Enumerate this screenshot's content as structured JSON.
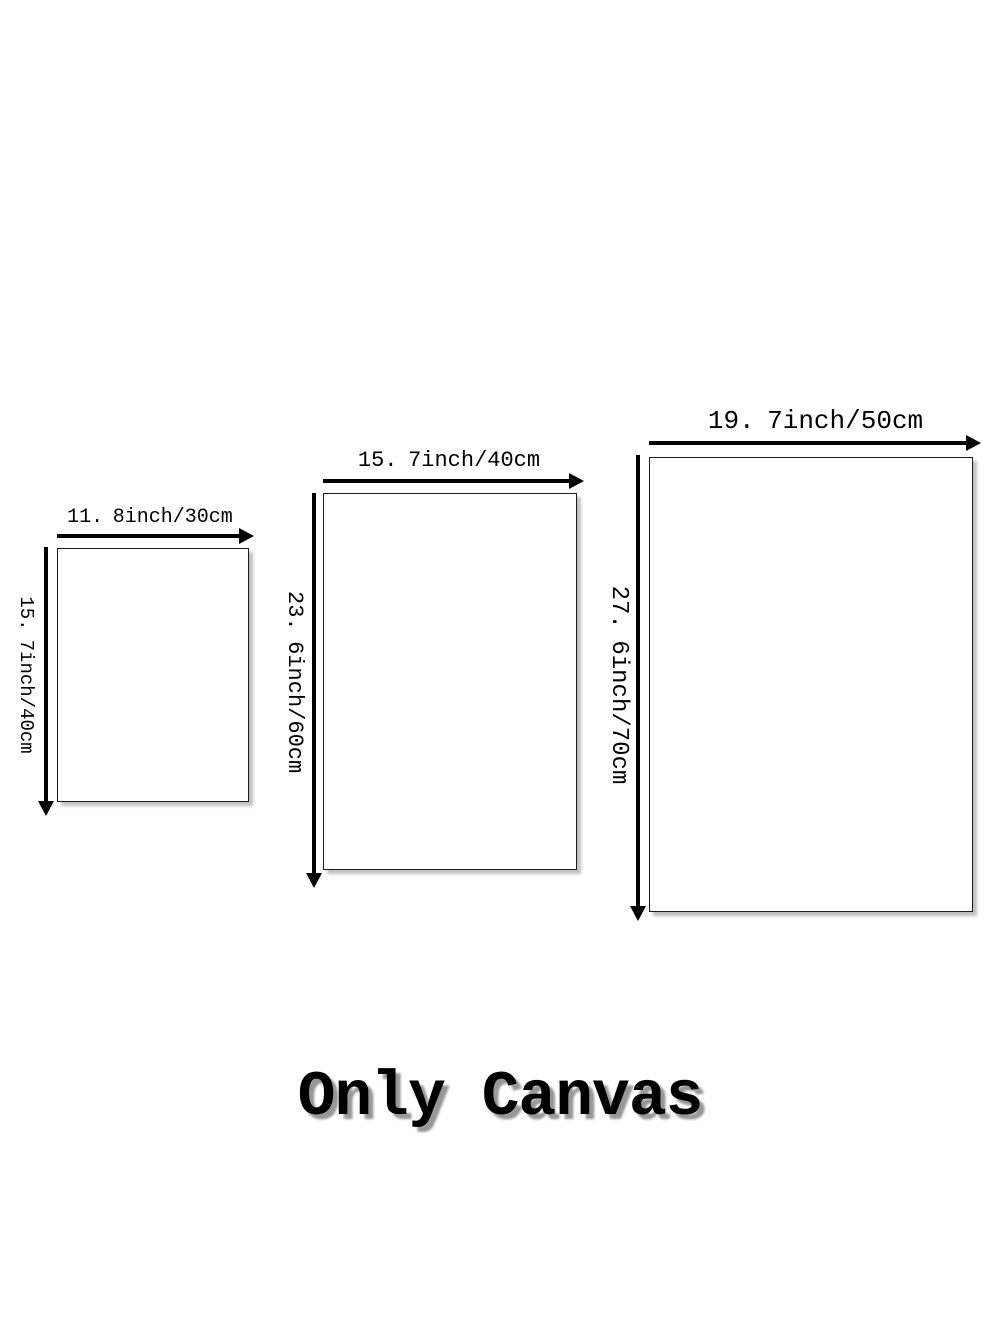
{
  "page": {
    "background_color": "#ffffff",
    "ink_color": "#000000",
    "shadow_color": "#979797",
    "footer": {
      "label": "Only Canvas"
    }
  },
  "canvases": [
    {
      "name": "small",
      "width_label": {
        "a": "11.",
        "b": "8inch/30cm"
      },
      "height_label": {
        "a": "15.",
        "b": "7inch/40cm"
      }
    },
    {
      "name": "medium",
      "width_label": {
        "a": "15.",
        "b": "7inch/40cm"
      },
      "height_label": {
        "a": "23.",
        "b": "6inch/60cm"
      }
    },
    {
      "name": "large",
      "width_label": {
        "a": "19.",
        "b": "7inch/50cm"
      },
      "height_label": {
        "a": "27.",
        "b": "6inch/70cm"
      }
    }
  ]
}
